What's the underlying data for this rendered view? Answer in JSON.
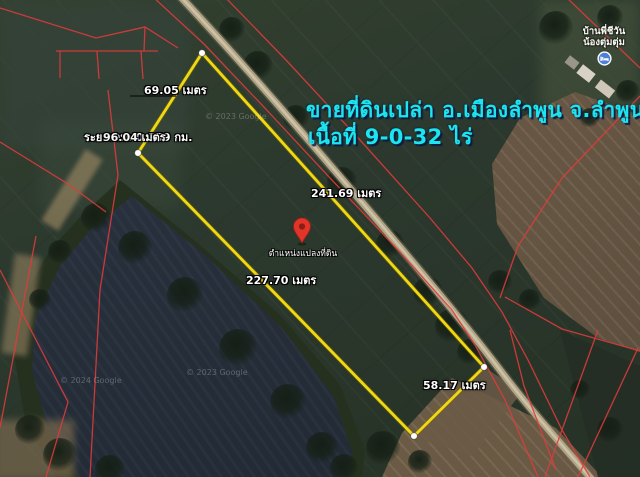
{
  "map": {
    "type": "google-maps-satellite",
    "ad_overlay": {
      "line1": "ขายที่ดินเปล่า อ.เมืองลำพูน  จ.ลำพูน",
      "line2": "เนื้อที่  9-0-32 ไร่",
      "color": "#1be5ee"
    },
    "measurements": {
      "edge_top_left": "69.05 เมตร",
      "edge_top_right": "241.69 เมตร",
      "edge_bottom_left": "227.70 เมตร",
      "edge_bottom_right": "58.17 เมตร",
      "total_distance_label": "ระยะรวม: 0.359 กม.",
      "overlapping_segment_label": "96.04 เมตร",
      "polygon_color": "#f0d815",
      "vertex_dot_color": "#ffffff"
    },
    "pin": {
      "label": "ตำแหน่งแปลงที่ดิน",
      "color": "#e03528"
    },
    "place_marker": {
      "line1": "บ้านพี่ชีวัน",
      "line2": "น้องตุ่มตุ่ม",
      "icon": "lodging-icon",
      "icon_color": "#4e80d6"
    },
    "cadastral_line_color": "#e23b3b",
    "watermarks": {
      "0": "© 2023 Google",
      "1": "© 2023 Google",
      "2": "© 2024 Google"
    }
  }
}
